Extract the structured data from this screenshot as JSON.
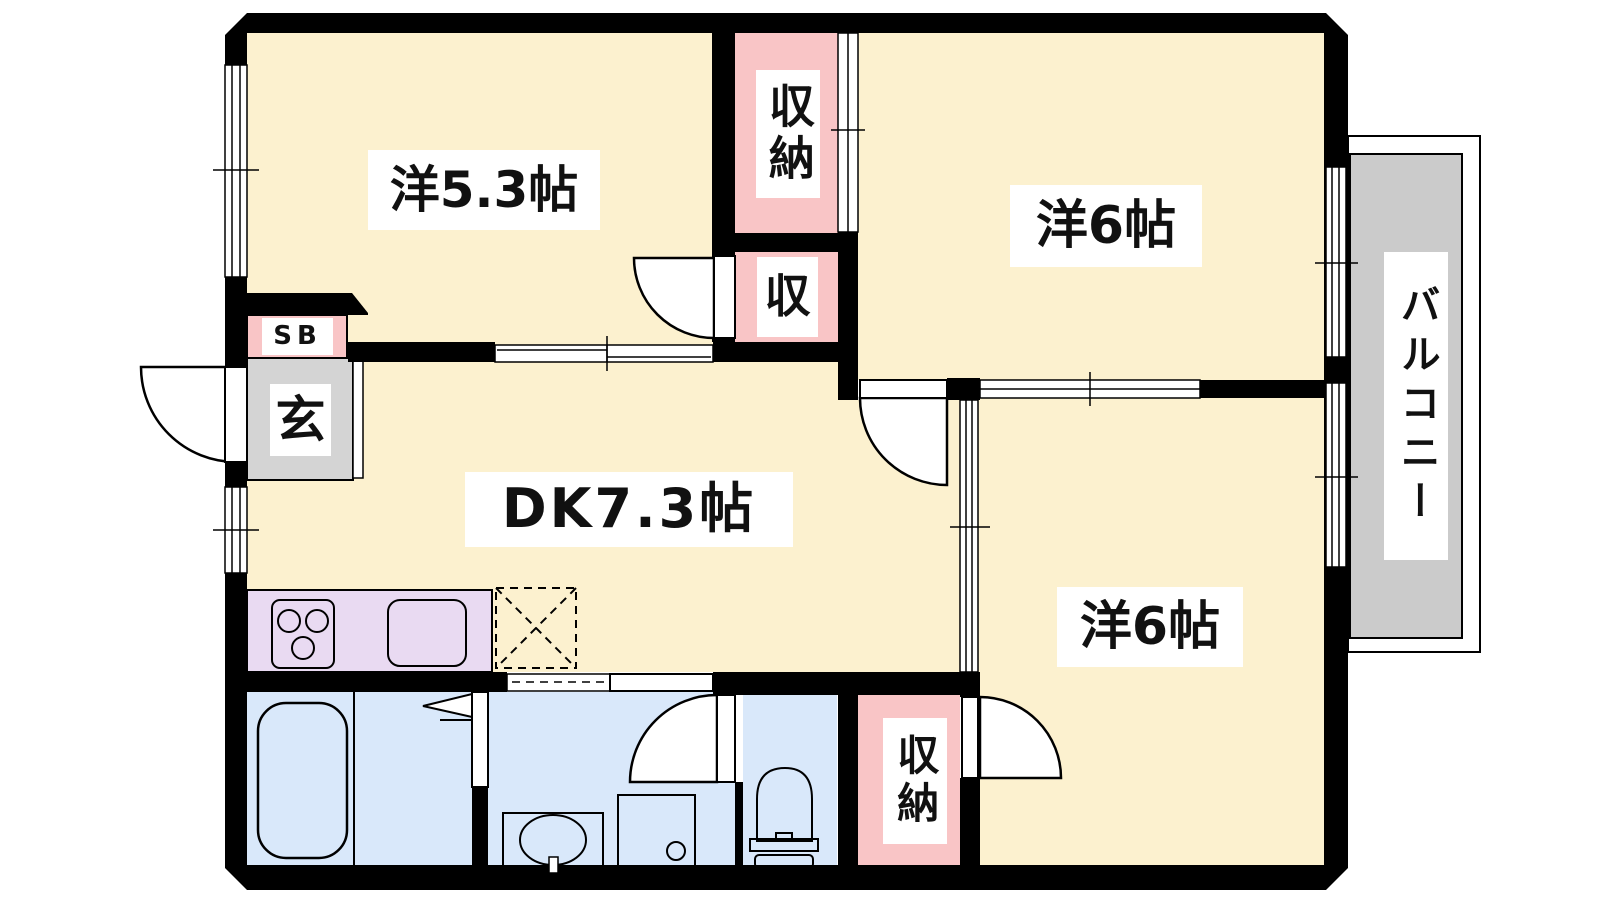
{
  "plan": {
    "type": "2DK apartment floor plan",
    "labels": {
      "room_west": "洋5.3帖",
      "room_east": "洋6帖",
      "room_south": "洋6帖",
      "dining_kitchen": "DK7.3帖",
      "closet_north": "収納",
      "closet_mid": "収",
      "closet_south": "収納",
      "shoe_box": "SB",
      "entrance": "玄",
      "balcony": "バルコニー"
    },
    "colors": {
      "room_floor": "#fcf1cf",
      "closet": "#f9c5c6",
      "wet_area": "#d9e8fa",
      "kitchen_counter": "#e9daf2",
      "entrance_floor": "#d4d4d4",
      "balcony_deck": "#cbcbcb",
      "wall": "#000000"
    }
  }
}
